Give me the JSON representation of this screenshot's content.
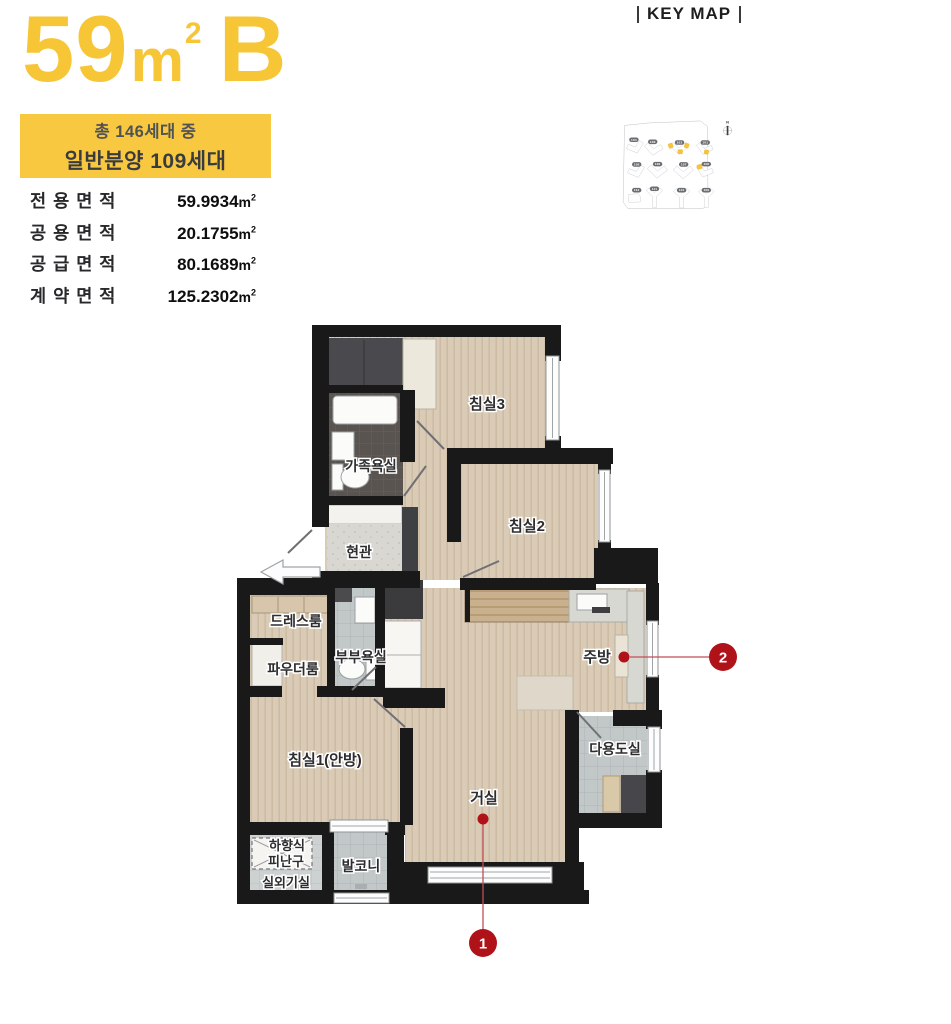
{
  "header": {
    "area_number": "59",
    "area_unit_m": "m",
    "area_unit_sup": "2",
    "type_letter": "B",
    "badge_line1": "총 146세대 중",
    "badge_line2": "일반분양 109세대"
  },
  "areas": {
    "unit_m": "m",
    "unit_sup": "2",
    "rows": [
      {
        "label": "전용면적",
        "value": "59.9934"
      },
      {
        "label": "공용면적",
        "value": "20.1755"
      },
      {
        "label": "공급면적",
        "value": "80.1689"
      },
      {
        "label": "계약면적",
        "value": "125.2302"
      }
    ]
  },
  "keymap": {
    "title": "KEY MAP",
    "compass_label": "N",
    "buildings": [
      {
        "label": "104",
        "highlighted": false
      },
      {
        "label": "103",
        "highlighted": false
      },
      {
        "label": "102",
        "highlighted": true
      },
      {
        "label": "101",
        "highlighted": true
      },
      {
        "label": "105",
        "highlighted": false
      },
      {
        "label": "106",
        "highlighted": false
      },
      {
        "label": "107",
        "highlighted": false
      },
      {
        "label": "108",
        "highlighted": true
      },
      {
        "label": "112",
        "highlighted": false
      },
      {
        "label": "111",
        "highlighted": false
      },
      {
        "label": "110",
        "highlighted": false
      },
      {
        "label": "109",
        "highlighted": false
      }
    ]
  },
  "plan": {
    "rooms": [
      {
        "label": "침실3"
      },
      {
        "label": "침실2"
      },
      {
        "label": "가족욕실"
      },
      {
        "label": "현관"
      },
      {
        "label": "드레스룸"
      },
      {
        "label": "부부욕실"
      },
      {
        "label": "파우더룸"
      },
      {
        "label": "침실1(안방)"
      },
      {
        "label": "주방"
      },
      {
        "label": "다용도실"
      },
      {
        "label": "거실"
      },
      {
        "label": "발코니"
      },
      {
        "label": "하향식"
      },
      {
        "label": "피난구"
      },
      {
        "label": "실외기실"
      }
    ],
    "markers": [
      {
        "num": "1"
      },
      {
        "num": "2"
      }
    ]
  },
  "colors": {
    "accent_yellow": "#F7C636",
    "badge_yellow": "#F8C940",
    "marker_red": "#B01219",
    "keymap_pill_gray": "#6A6E72",
    "wall_black": "#191919"
  }
}
